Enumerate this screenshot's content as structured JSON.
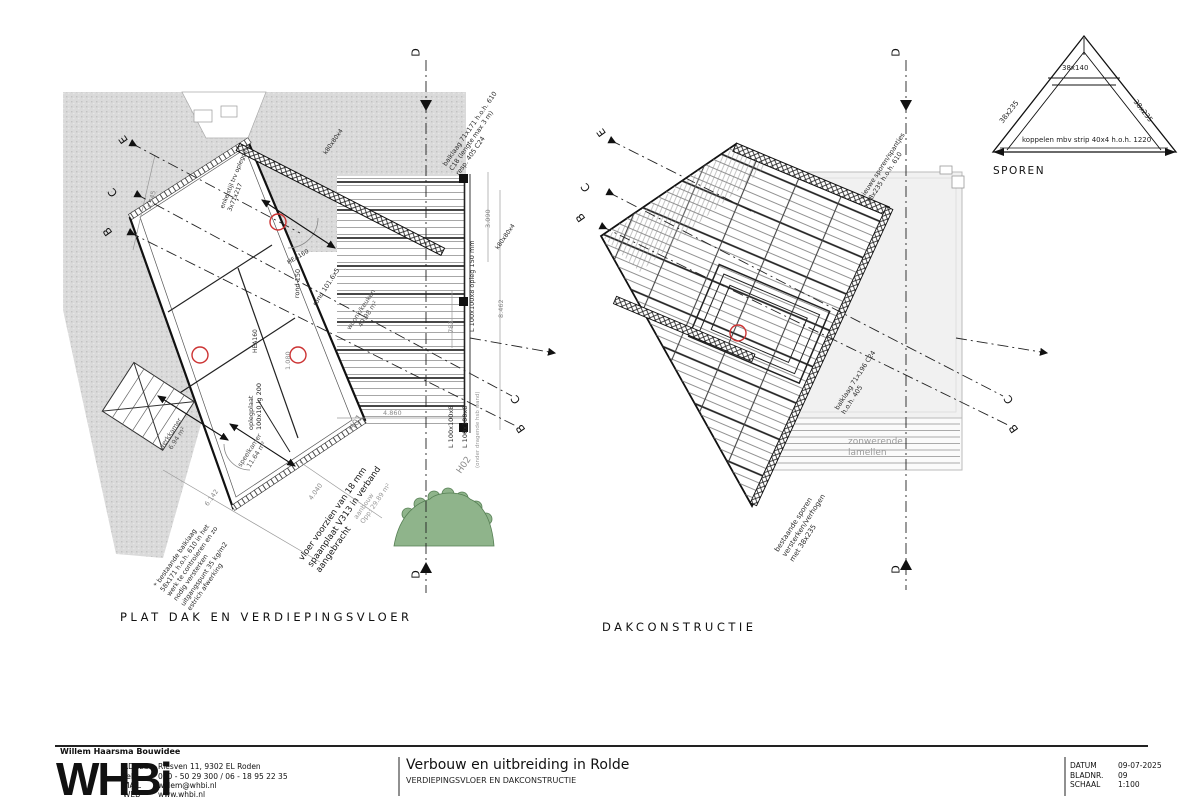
{
  "sheet": {
    "company": "Willem Haarsma Bouwidee",
    "logo": "WHBi",
    "adres_label": "ADRES",
    "adres": "Riesven 11, 9302 EL Roden",
    "tel_label": "Tel",
    "tel": "050 - 50 29 300 / 06 - 18 95 22 35",
    "mail_label": "MAIL",
    "mail": "willem@whbi.nl",
    "web_label": "WEB",
    "web": "www.whbi.nl",
    "title": "Verbouw en uitbreiding in Rolde",
    "subtitle": "VERDIEPINGSVLOER EN DAKCONSTRUCTIE",
    "datum_label": "DATUM",
    "datum": "09-07-2025",
    "bladnr_label": "BLADNR.",
    "bladnr": "09",
    "schaal_label": "SCHAAL",
    "schaal": "1:100"
  },
  "detail": {
    "label": "SPOREN",
    "collar": "38x140",
    "rafter_left": "38x235",
    "rafter_right": "38x235",
    "note": "koppelen mbv strip 40x4 h.o.h. 1220"
  },
  "left": {
    "label": "PLAT DAK EN VERDIEPINGSVLOER",
    "markers": {
      "d": "D",
      "e": "E",
      "c": "C",
      "b": "B"
    },
    "h01": "H01",
    "h02": "H02",
    "ann": {
      "balklaag": "balklaag 71x171 h.o.h. 610\nC18 (lengte max 3 m)\nresp. 405 C24",
      "bestaande": "* bestaande balklaag\n58x171 h.o.h. 610 in het\nwerk te controleren en zo\nnodig versterken\nuitgangspunt 35 kg/m2\nestrich afwerking",
      "vloer": "vloer voorzien van 18 mm\nspaanplaat V313 in verband\naangebracht",
      "aanbouw": "aanbouw\nOpp: 29.89 m²",
      "enkelstijl": "enkelstijl trv oplegging\n3x71x217",
      "oplegplaat": "oplegplaat\n100x10 lg 200",
      "rond": "rond 101.6x5",
      "rond150": "rond 150",
      "l_opleg": "L 100x100x8 opleg 150 mm",
      "l2": "L 100x100x8",
      "onder": "(onder dragende hsb wand)",
      "k80": "k80x80x4",
      "hea": "HEA160"
    },
    "rooms": {
      "werkkamer": "werkkamer\n6.94 m²",
      "speelkamer": "speelkamer\n11.64 m²",
      "woonk": "woonk/keuken\n49.98 m²"
    },
    "dims": {
      "d4860": "4.860",
      "d6142": "6.142",
      "d4040": "4.040",
      "d8462": "8.462",
      "d3090": "3.090",
      "d783": "783",
      "d4745": "4.745",
      "d1080": "1.080"
    }
  },
  "right": {
    "label": "DAKCONSTRUCTIE",
    "markers": {
      "d": "D",
      "e": "E",
      "c": "C",
      "b": "B"
    },
    "ann": {
      "nieuwe": "nieuwe sporen/spantjes\n38x235 h.o.h. 610",
      "balklaag": "balklaag 71x196 C24\nh.o.h. 405",
      "bestaande": "bestaande sporen\nversterken/verhogen\nmet 38x235",
      "zonwerend": "zonwerende\nlamellen"
    }
  }
}
